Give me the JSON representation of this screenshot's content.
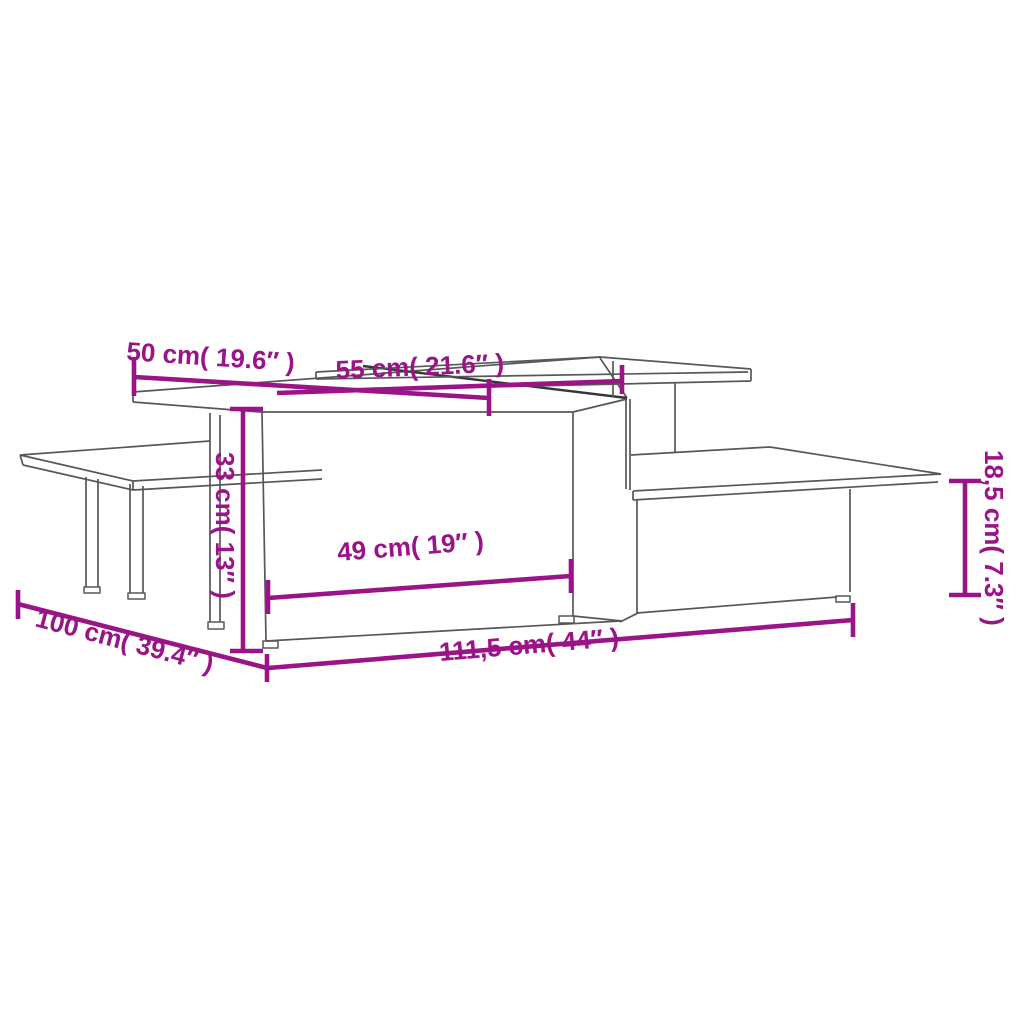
{
  "diagram": {
    "type": "furniture-dimension-drawing",
    "subject": "nesting coffee table set (2 pcs), isometric wireframe",
    "dimensions": [
      {
        "id": "depth-top",
        "label": "50 cm( 19.6″ )",
        "cm": "50",
        "inches": "19.6"
      },
      {
        "id": "shelf-length",
        "label": "55 cm( 21.6″ )",
        "cm": "55",
        "inches": "21.6"
      },
      {
        "id": "height-tall",
        "label": "33 cm( 13″ )",
        "cm": "33",
        "inches": "13"
      },
      {
        "id": "inner-length",
        "label": "49 cm( 19″ )",
        "cm": "49",
        "inches": "19"
      },
      {
        "id": "depth-total",
        "label": "100 cm( 39.4″ )",
        "cm": "100",
        "inches": "39.4"
      },
      {
        "id": "length-total",
        "label": "111,5 cm( 44″ )",
        "cm": "111,5",
        "inches": "44"
      },
      {
        "id": "height-low",
        "label": "18,5 cm( 7.3″ )",
        "cm": "18,5",
        "inches": "7.3"
      }
    ],
    "colors": {
      "dimension_line": "#9a1387",
      "furniture_outline": "#57575a",
      "furniture_dark_edge": "#36363a",
      "background": "#ffffff"
    }
  }
}
